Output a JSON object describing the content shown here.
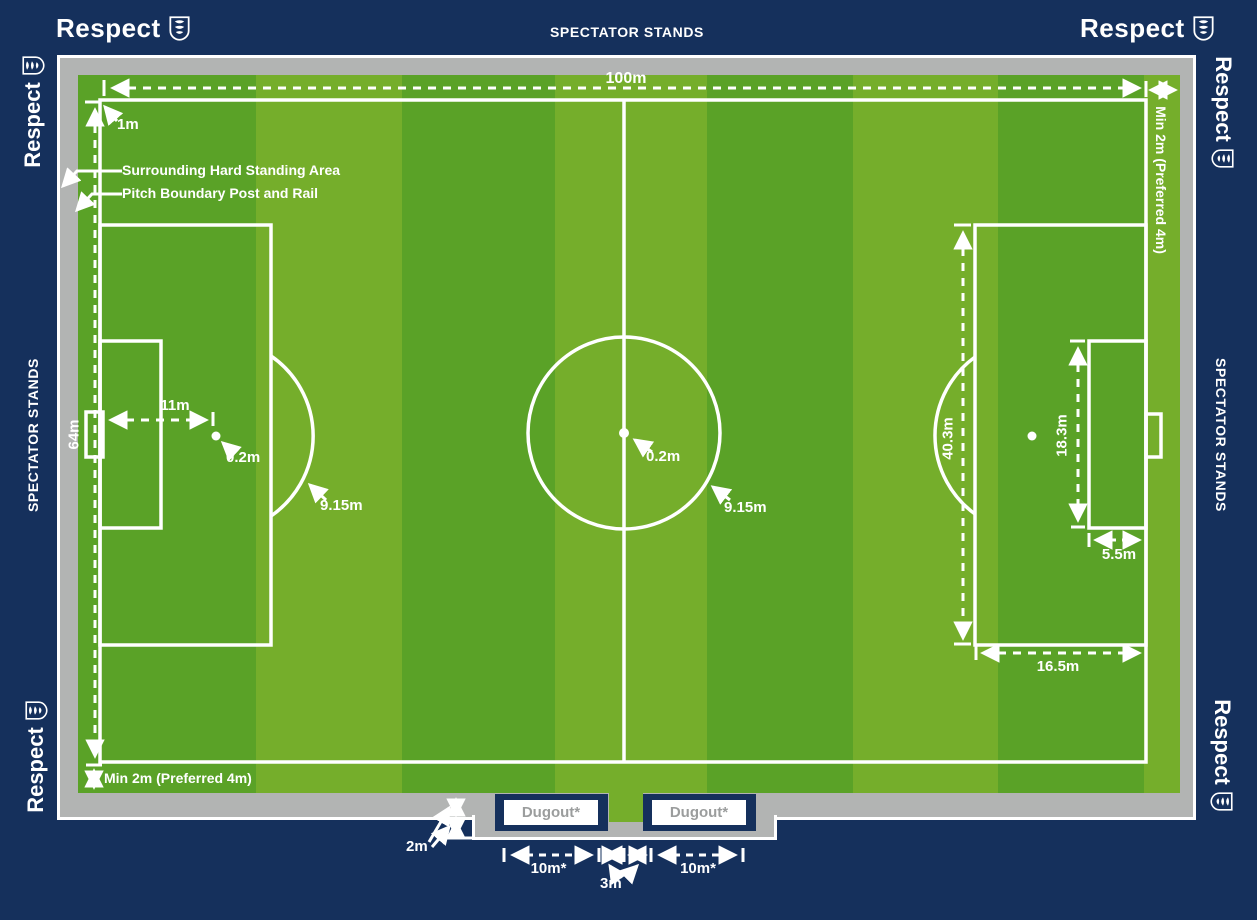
{
  "colors": {
    "navy": "#15305c",
    "gray": "#b2b4b3",
    "green_dark": "#5aa227",
    "green_light": "#75ae2b",
    "white": "#ffffff",
    "dugout_text": "#9b9d9d"
  },
  "branding": {
    "respect": "Respect",
    "stands": "SPECTATOR STANDS"
  },
  "measurements": {
    "pitch_length": "100m",
    "corner_offset": "1m",
    "hard_standing": "Surrounding Hard Standing Area",
    "post_rail": "Pitch Boundary Post and Rail",
    "pitch_width": "64m",
    "penalty_distance": "11m",
    "penalty_spot": "0.2m",
    "penalty_arc": "9.15m",
    "centre_spot": "0.2m",
    "centre_circle": "9.15m",
    "penalty_area_width": "40.3m",
    "goal_area_width": "18.3m",
    "goal_area_depth": "5.5m",
    "penalty_area_depth": "16.5m",
    "runoff_right": "Min 2m (Preferred 4m)",
    "runoff_bottom": "Min 2m (Preferred 4m)",
    "standing_depth": "2m",
    "dugout_offset_left": "10m*",
    "dugout_gap": "3m",
    "dugout_offset_right": "10m*"
  },
  "dugouts": {
    "left": "Dugout*",
    "right": "Dugout*"
  }
}
